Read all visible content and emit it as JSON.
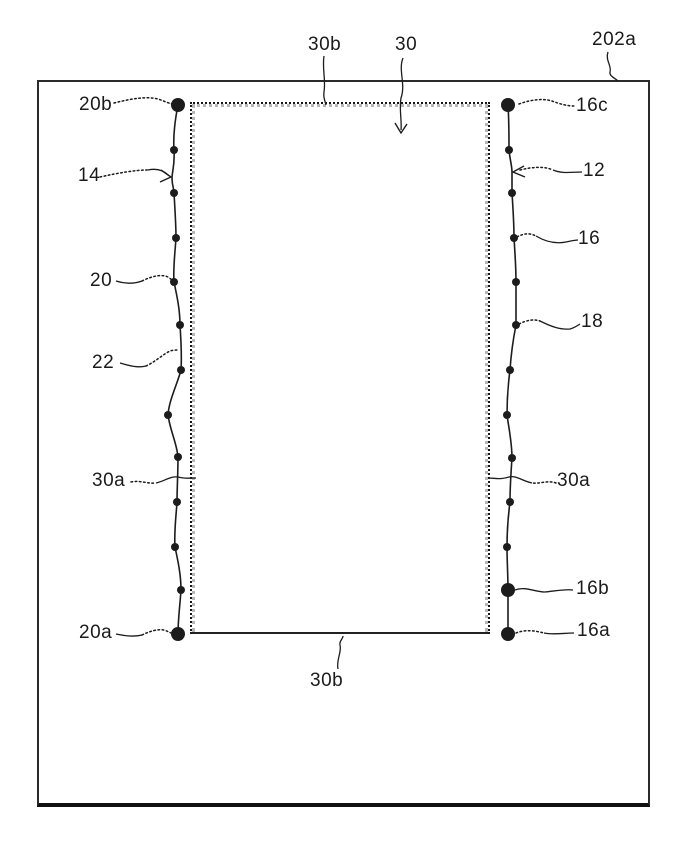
{
  "figure": {
    "kind": "patent-style-diagram",
    "description": "Rectangular substrate 202a with inner sealed region 30 bounded by stippled seal lines 30b/30a and two vertical electrode chains with terminal dots",
    "reference_labels_top": [
      "30b",
      "30",
      "202a"
    ],
    "reference_labels_left": [
      "20b",
      "14",
      "20",
      "22",
      "30a",
      "20a"
    ],
    "reference_labels_right": [
      "16c",
      "12",
      "16",
      "18",
      "30a",
      "16b",
      "16a"
    ],
    "reference_labels_bottom": [
      "30b"
    ]
  },
  "labels": {
    "l20b": "20b",
    "l14": "14",
    "l20": "20",
    "l22": "22",
    "l30a_left": "30a",
    "l20a": "20a",
    "l16c": "16c",
    "l12": "12",
    "l16": "16",
    "l18": "18",
    "l30a_right": "30a",
    "l16b": "16b",
    "l16a": "16a",
    "l30b_top": "30b",
    "l30": "30",
    "l202a": "202a",
    "l30b_bottom": "30b"
  },
  "colors": {
    "ink": "#1c1c1c",
    "seal_dark": "#161616",
    "seal_light": "#b7b7b7",
    "background": "#ffffff"
  },
  "dots": {
    "small_radius": 4,
    "large_radius": 7,
    "left_small": [
      [
        174,
        150
      ],
      [
        174,
        193
      ],
      [
        176,
        238
      ],
      [
        174,
        282
      ],
      [
        180,
        325
      ],
      [
        181,
        370
      ],
      [
        168,
        415
      ],
      [
        178,
        457
      ],
      [
        177,
        502
      ],
      [
        175,
        547
      ],
      [
        181,
        590
      ]
    ],
    "right_small": [
      [
        509,
        150
      ],
      [
        512,
        193
      ],
      [
        514,
        238
      ],
      [
        516,
        282
      ],
      [
        516,
        325
      ],
      [
        510,
        370
      ],
      [
        507,
        415
      ],
      [
        512,
        458
      ],
      [
        510,
        502
      ],
      [
        507,
        547
      ]
    ],
    "large": [
      [
        178,
        105
      ],
      [
        178,
        634
      ],
      [
        508,
        105
      ],
      [
        508,
        590
      ],
      [
        508,
        634
      ]
    ]
  }
}
